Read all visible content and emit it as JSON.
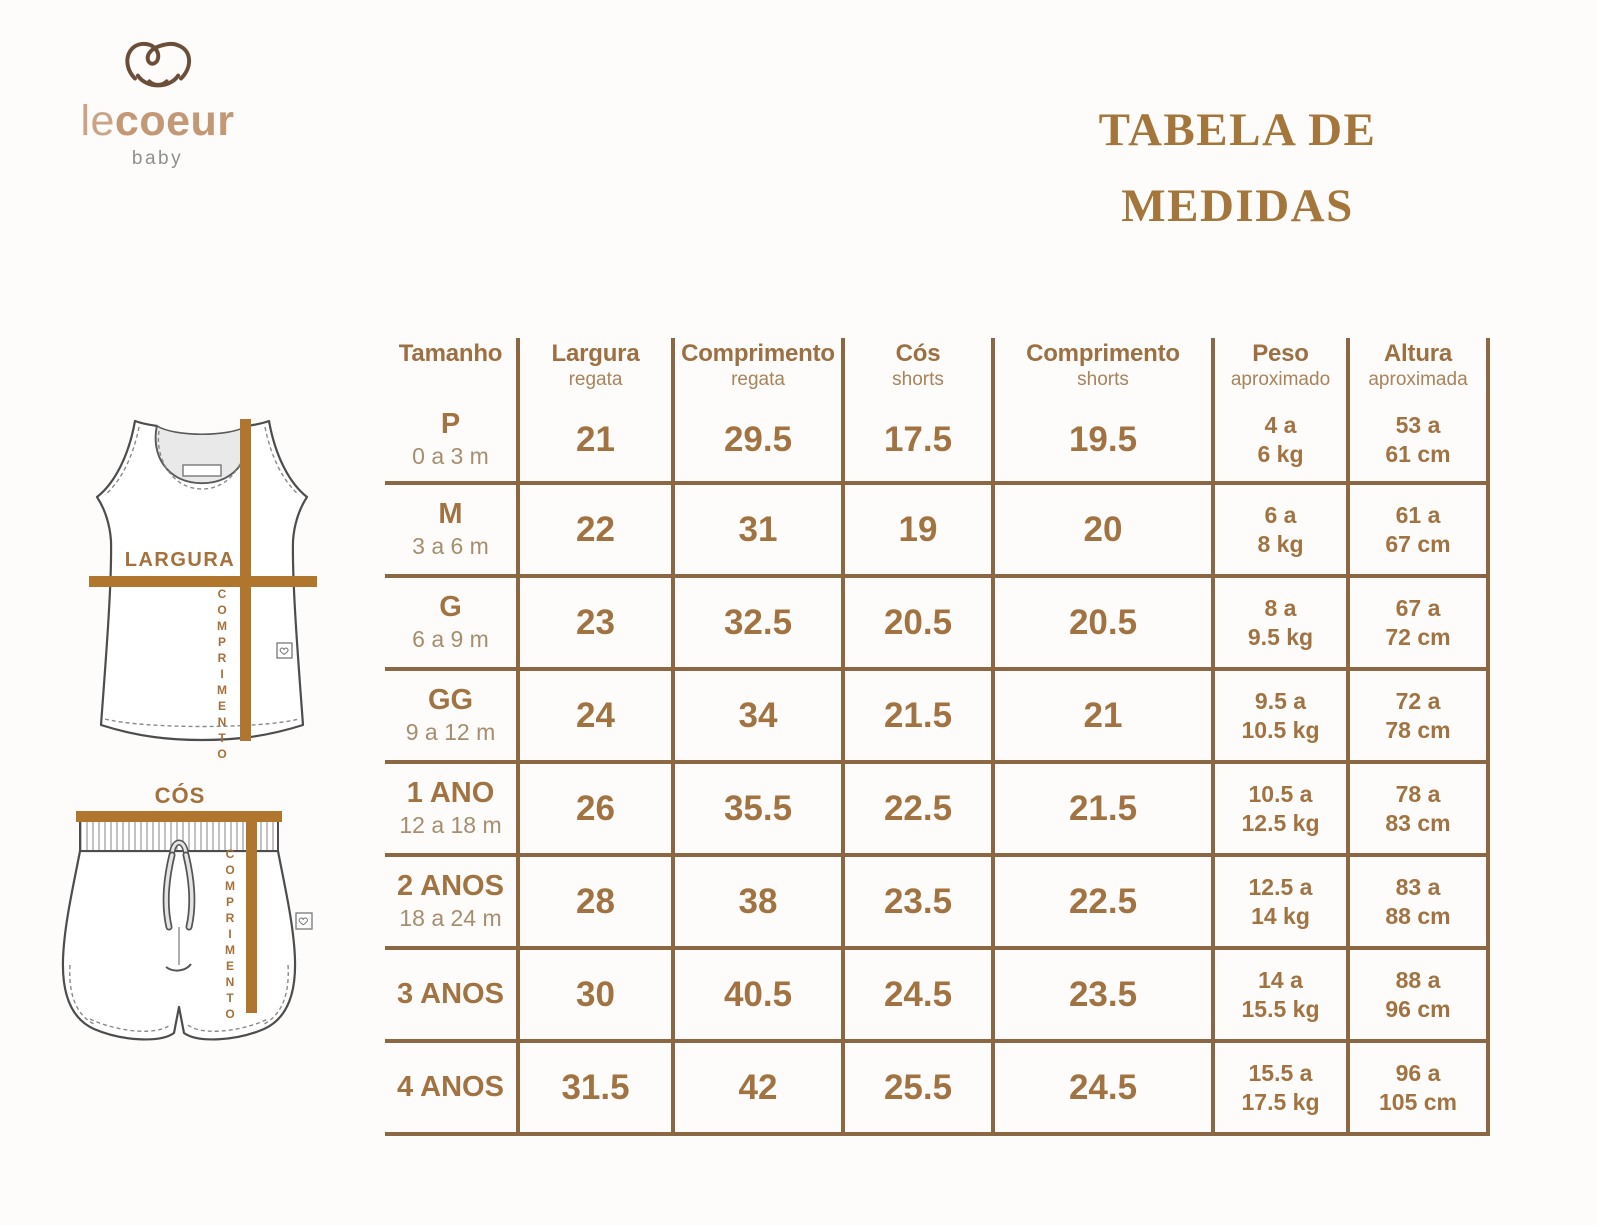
{
  "logo": {
    "text_le": "le",
    "text_coeur": "coeur",
    "subtext": "baby"
  },
  "title": {
    "line1": "TABELA DE",
    "line2": "MEDIDAS"
  },
  "diagram": {
    "tank": {
      "largura": "LARGURA",
      "comprimento": "COMPRIMENTO"
    },
    "shorts": {
      "cos": "CÓS",
      "comprimento": "COMPRIMENTO"
    }
  },
  "table": {
    "headers": [
      {
        "main": "Tamanho",
        "sub": ""
      },
      {
        "main": "Largura",
        "sub": "regata"
      },
      {
        "main": "Comprimento",
        "sub": "regata"
      },
      {
        "main": "Cós",
        "sub": "shorts"
      },
      {
        "main": "Comprimento",
        "sub": "shorts"
      },
      {
        "main": "Peso",
        "sub": "aproximado"
      },
      {
        "main": "Altura",
        "sub": "aproximada"
      }
    ],
    "rows": [
      {
        "size": "P",
        "age": "0 a 3 m",
        "largura_regata": "21",
        "comprimento_regata": "29.5",
        "cos_shorts": "17.5",
        "comprimento_shorts": "19.5",
        "peso_l1": "4 a",
        "peso_l2": "6 kg",
        "altura_l1": "53 a",
        "altura_l2": "61 cm"
      },
      {
        "size": "M",
        "age": "3 a 6 m",
        "largura_regata": "22",
        "comprimento_regata": "31",
        "cos_shorts": "19",
        "comprimento_shorts": "20",
        "peso_l1": "6 a",
        "peso_l2": "8 kg",
        "altura_l1": "61 a",
        "altura_l2": "67 cm"
      },
      {
        "size": "G",
        "age": "6 a 9 m",
        "largura_regata": "23",
        "comprimento_regata": "32.5",
        "cos_shorts": "20.5",
        "comprimento_shorts": "20.5",
        "peso_l1": "8 a",
        "peso_l2": "9.5 kg",
        "altura_l1": "67 a",
        "altura_l2": "72 cm"
      },
      {
        "size": "GG",
        "age": "9 a 12 m",
        "largura_regata": "24",
        "comprimento_regata": "34",
        "cos_shorts": "21.5",
        "comprimento_shorts": "21",
        "peso_l1": "9.5 a",
        "peso_l2": "10.5 kg",
        "altura_l1": "72 a",
        "altura_l2": "78 cm"
      },
      {
        "size": "1 ANO",
        "age": "12 a 18 m",
        "largura_regata": "26",
        "comprimento_regata": "35.5",
        "cos_shorts": "22.5",
        "comprimento_shorts": "21.5",
        "peso_l1": "10.5 a",
        "peso_l2": "12.5 kg",
        "altura_l1": "78 a",
        "altura_l2": "83 cm"
      },
      {
        "size": "2 ANOS",
        "age": "18 a 24 m",
        "largura_regata": "28",
        "comprimento_regata": "38",
        "cos_shorts": "23.5",
        "comprimento_shorts": "22.5",
        "peso_l1": "12.5 a",
        "peso_l2": "14 kg",
        "altura_l1": "83 a",
        "altura_l2": "88 cm"
      },
      {
        "size": "3 ANOS",
        "age": "",
        "largura_regata": "30",
        "comprimento_regata": "40.5",
        "cos_shorts": "24.5",
        "comprimento_shorts": "23.5",
        "peso_l1": "14 a",
        "peso_l2": "15.5 kg",
        "altura_l1": "88 a",
        "altura_l2": "96 cm"
      },
      {
        "size": "4 ANOS",
        "age": "",
        "largura_regata": "31.5",
        "comprimento_regata": "42",
        "cos_shorts": "25.5",
        "comprimento_shorts": "24.5",
        "peso_l1": "15.5 a",
        "peso_l2": "17.5 kg",
        "altura_l1": "96 a",
        "altura_l2": "105 cm"
      }
    ]
  },
  "colors": {
    "brand_brown": "#9C7044",
    "title_brown": "#A5763C",
    "line_brown": "#8B6843",
    "bar_brown": "#B0762E",
    "sub_brown": "#A68D6F",
    "logo_tan": "#CBA487",
    "heart_brown": "#6B4E39",
    "baby_gray": "#8F8F8F"
  },
  "chart_data": {
    "type": "table",
    "title": "TABELA DE MEDIDAS",
    "columns": [
      "Tamanho",
      "Largura regata",
      "Comprimento regata",
      "Cós shorts",
      "Comprimento shorts",
      "Peso aproximado",
      "Altura aproximada"
    ],
    "rows": [
      [
        "P (0 a 3 m)",
        21,
        29.5,
        17.5,
        19.5,
        "4 a 6 kg",
        "53 a 61 cm"
      ],
      [
        "M (3 a 6 m)",
        22,
        31,
        19,
        20,
        "6 a 8 kg",
        "61 a 67 cm"
      ],
      [
        "G (6 a 9 m)",
        23,
        32.5,
        20.5,
        20.5,
        "8 a 9.5 kg",
        "67 a 72 cm"
      ],
      [
        "GG (9 a 12 m)",
        24,
        34,
        21.5,
        21,
        "9.5 a 10.5 kg",
        "72 a 78 cm"
      ],
      [
        "1 ANO (12 a 18 m)",
        26,
        35.5,
        22.5,
        21.5,
        "10.5 a 12.5 kg",
        "78 a 83 cm"
      ],
      [
        "2 ANOS (18 a 24 m)",
        28,
        38,
        23.5,
        22.5,
        "12.5 a 14 kg",
        "83 a 88 cm"
      ],
      [
        "3 ANOS",
        30,
        40.5,
        24.5,
        23.5,
        "14 a 15.5 kg",
        "88 a 96 cm"
      ],
      [
        "4 ANOS",
        31.5,
        42,
        25.5,
        24.5,
        "15.5 a 17.5 kg",
        "96 a 105 cm"
      ]
    ]
  }
}
